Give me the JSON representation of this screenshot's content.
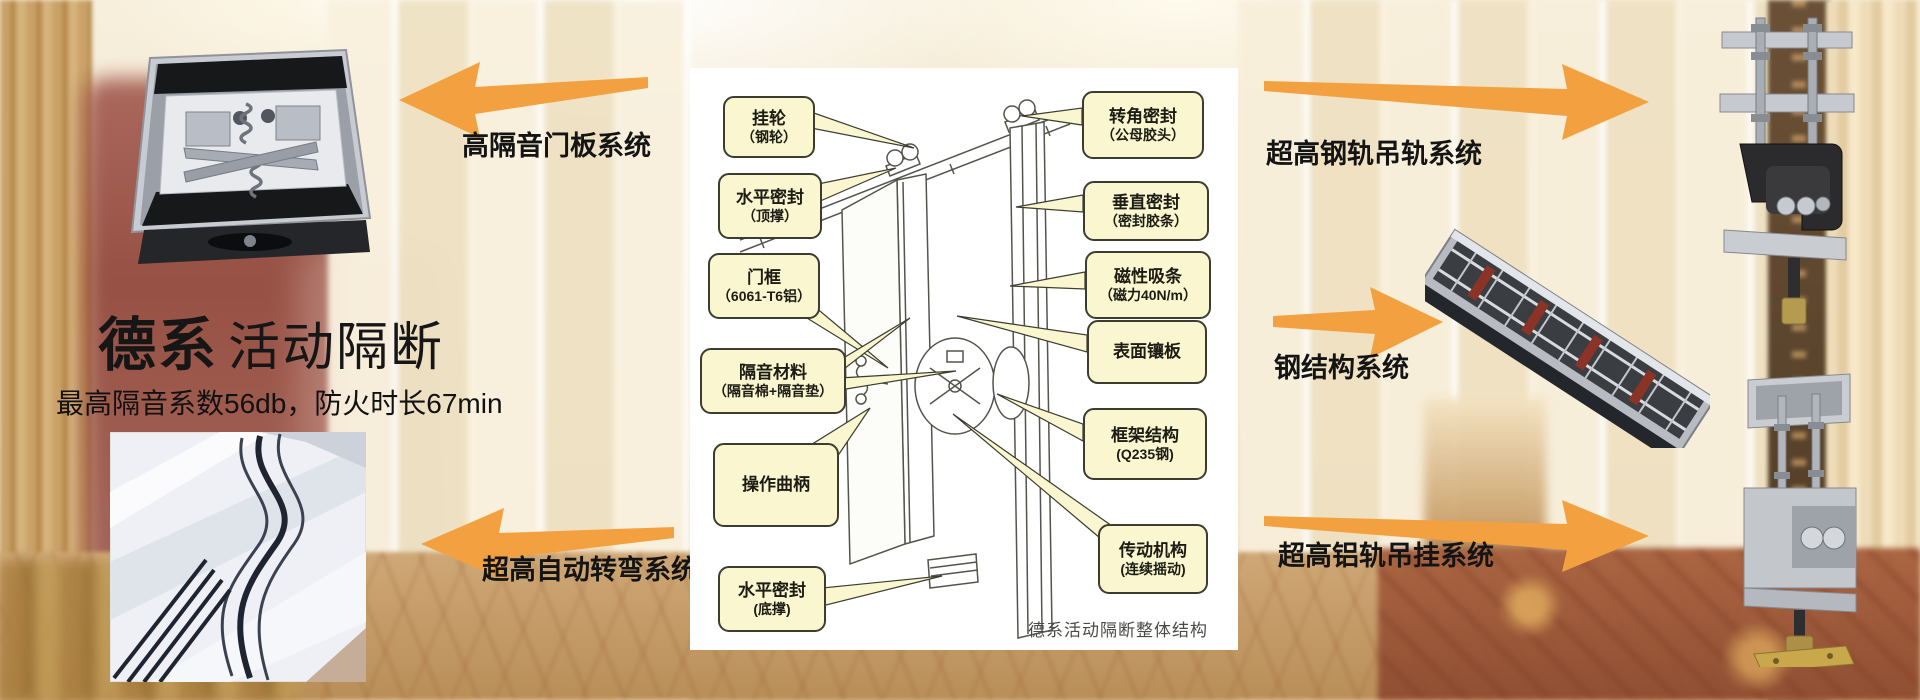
{
  "page": {
    "title_bold": "德系",
    "title_rest": "活动隔断",
    "subtitle": "最高隔音系数56db，防火时长67min"
  },
  "arrows": {
    "door_panel": {
      "label": "高隔音门板系统",
      "direction": "left"
    },
    "auto_turn": {
      "label": "超高自动转弯系统",
      "direction": "left"
    },
    "steel_rail": {
      "label": "超高钢轨吊轨系统",
      "direction": "right"
    },
    "steel_structure": {
      "label": "钢结构系统",
      "direction": "right"
    },
    "alu_rail": {
      "label": "超高铝轨吊挂系统",
      "direction": "right"
    }
  },
  "diagram": {
    "caption": "德系活动隔断整体结构",
    "callouts_left": [
      {
        "line1": "挂轮",
        "line2": "（钢轮）"
      },
      {
        "line1": "水平密封",
        "line2": "（顶撑）"
      },
      {
        "line1": "门框",
        "line2": "（6061-T6铝）"
      },
      {
        "line1": "隔音材料",
        "line2": "（隔音棉+隔音垫）"
      },
      {
        "line1": "操作曲柄",
        "line2": ""
      },
      {
        "line1": "水平密封",
        "line2": "(底撑)"
      }
    ],
    "callouts_right": [
      {
        "line1": "转角密封",
        "line2": "（公母胶头）"
      },
      {
        "line1": "垂直密封",
        "line2": "（密封胶条）"
      },
      {
        "line1": "磁性吸条",
        "line2": "（磁力40N/m）"
      },
      {
        "line1": "表面镶板",
        "line2": ""
      },
      {
        "line1": "框架结构",
        "line2": "(Q235钢)"
      },
      {
        "line1": "传动机构",
        "line2": "(连续摇动)"
      }
    ]
  },
  "colors": {
    "accent_orange": "#F3A140",
    "callout_fill": "#FAF7D0",
    "callout_border": "#3C3C30",
    "diagram_background": "#FFFFFF"
  }
}
